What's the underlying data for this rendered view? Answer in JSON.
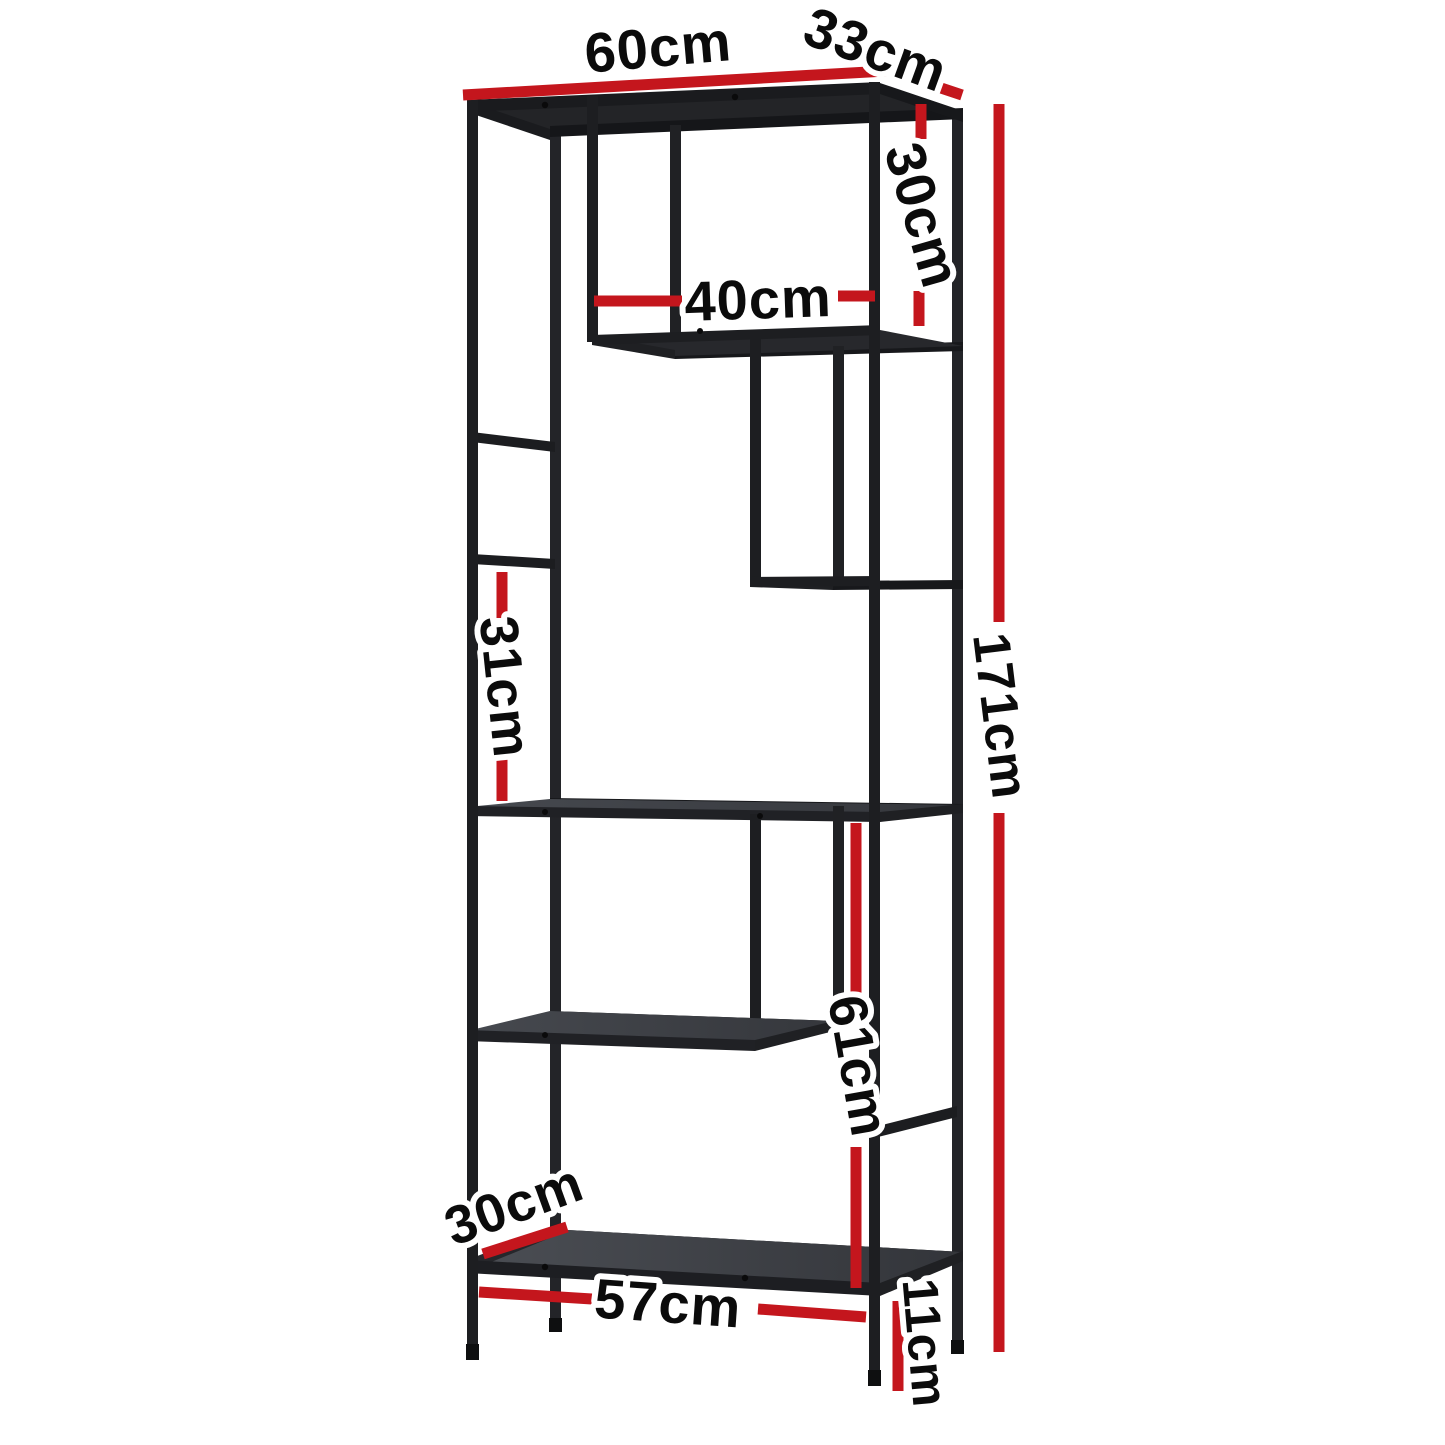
{
  "page": {
    "background": "#ffffff",
    "canvas_width": 1445,
    "canvas_height": 1445,
    "description": "Dimension diagram of a black metal open display shelving unit"
  },
  "colors": {
    "accent_red": "#c4161d",
    "frame_black": "#1d1e21",
    "shelf_gray": "#43464c",
    "label_text": "#0b0b0b",
    "label_halo": "#ffffff"
  },
  "product": {
    "name": "display-shelf-unit",
    "finish": "black metal frame with dark shelf panels"
  },
  "dimensions": {
    "top_width": {
      "label": "60cm",
      "value": 60,
      "unit": "cm"
    },
    "top_depth": {
      "label": "33cm",
      "value": 33,
      "unit": "cm"
    },
    "top_section": {
      "label": "30cm",
      "value": 30,
      "unit": "cm"
    },
    "opening_width": {
      "label": "40cm",
      "value": 40,
      "unit": "cm"
    },
    "middle_section": {
      "label": "31cm",
      "value": 31,
      "unit": "cm"
    },
    "total_height": {
      "label": "171cm",
      "value": 171,
      "unit": "cm"
    },
    "lower_section": {
      "label": "61cm",
      "value": 61,
      "unit": "cm"
    },
    "bottom_depth": {
      "label": "30cm",
      "value": 30,
      "unit": "cm"
    },
    "bottom_width": {
      "label": "57cm",
      "value": 57,
      "unit": "cm"
    },
    "leg_height": {
      "label": "11cm",
      "value": 11,
      "unit": "cm"
    }
  }
}
